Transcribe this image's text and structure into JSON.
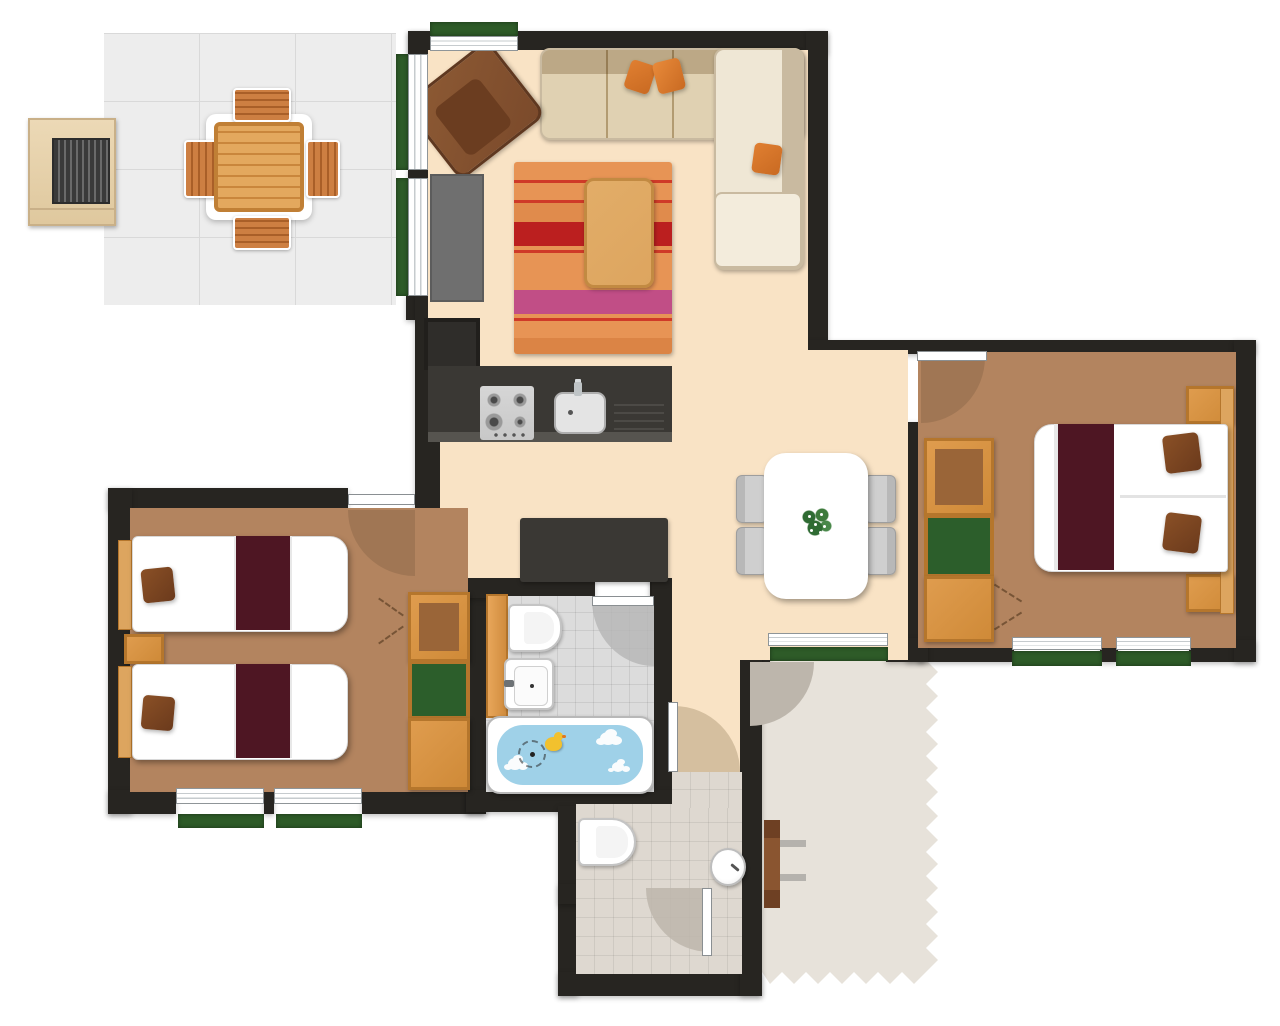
{
  "meta": {
    "kind": "floor-plan",
    "canvas_w": 1280,
    "canvas_h": 1026,
    "visible_text": "none"
  },
  "palette": {
    "wall": "#272521",
    "cream": "#f9e3c5",
    "wood_floor": "#b3845f",
    "bath_tile": "#dcdcdc",
    "wc_tile": "#ded8d0",
    "patio_tile": "#ededed",
    "path": "#e7e2da",
    "shutter_green": "#2e5b28",
    "orange_wood": "#df9c4e",
    "orange_wood_dark": "#b5762c",
    "shelf_green": "#2c5e2b",
    "shelf_brown": "#9a6538",
    "maroon": "#4e1623",
    "pillow_brown": "#7a4527",
    "sofa_cream": "#efe7d5",
    "sofa_border": "#c9baa0",
    "armchair_brown": "#7b4a2b",
    "cushion_orange": "#e07f31",
    "rug_base": "#e79455",
    "rug_red": "#cf3a28",
    "rug_dark_red": "#bb1f1f",
    "rug_magenta": "#c14e86",
    "table_wood": "#dda55f",
    "counter_dark": "#3a3834",
    "steel": "#d6d6d6",
    "chair_gray": "#cfcfcf",
    "water_blue": "#9fd1e8",
    "duck_yellow": "#f2c12e",
    "bench_wood": "#8a5530",
    "arc_wood": "#9c7352",
    "arc_gray": "#b5b5b5",
    "arc_tan": "#d5bf9f",
    "arc_path": "#bdb6ac",
    "tv_gray": "#6f6f6f",
    "dark_unit": "#2f2d2a"
  },
  "rooms": [
    {
      "id": "living-room",
      "floor": "cream",
      "furniture": [
        "corner-sofa",
        "sofa-cushions",
        "armchair",
        "striped-rug",
        "coffee-table",
        "media-unit"
      ]
    },
    {
      "id": "kitchen",
      "floor": "cream",
      "furniture": [
        "counter",
        "gas-hob",
        "sink",
        "drainer",
        "tall-appliance-unit"
      ]
    },
    {
      "id": "hall-dining",
      "floor": "cream",
      "furniture": [
        "dining-table",
        "dining-chairs-x4",
        "plant-centerpiece",
        "sideboard"
      ]
    },
    {
      "id": "master-bedroom",
      "floor": "wood",
      "furniture": [
        "double-bed",
        "maroon-runner",
        "pillows-x2",
        "headboard",
        "nightstand-x2",
        "wardrobe-with-shelves"
      ]
    },
    {
      "id": "twin-bedroom",
      "floor": "wood",
      "furniture": [
        "single-bed-x2",
        "maroon-runners",
        "pillows",
        "headboards",
        "nightstand",
        "wardrobe-with-shelves"
      ]
    },
    {
      "id": "bathroom",
      "floor": "bath-tile",
      "furniture": [
        "vanity-strip",
        "toilet",
        "washbasin",
        "bathtub",
        "bath-water",
        "foam-clouds-x3",
        "rubber-duck",
        "shower-head-dashed"
      ]
    },
    {
      "id": "wc",
      "floor": "wc-tile",
      "furniture": [
        "toilet",
        "round-washbasin",
        "inner-door"
      ]
    },
    {
      "id": "patio",
      "floor": "patio-tile",
      "furniture": [
        "bbq-grill",
        "garden-table",
        "garden-chairs-x4"
      ]
    },
    {
      "id": "entrance-path",
      "floor": "path",
      "furniture": [
        "bench",
        "entrance-door-arc"
      ]
    }
  ],
  "doors": [
    {
      "from": "hall-dining",
      "to": "master-bedroom"
    },
    {
      "from": "hall-dining",
      "to": "twin-bedroom"
    },
    {
      "from": "hall-dining",
      "to": "bathroom"
    },
    {
      "from": "corridor",
      "to": "wc"
    },
    {
      "from": "wc",
      "to": "inner-room"
    },
    {
      "from": "hall-dining",
      "to": "entrance-path"
    }
  ],
  "windows": [
    {
      "at": "living-room-top"
    },
    {
      "at": "living-room-left-glazing-x2"
    },
    {
      "at": "twin-bedroom-bottom-x2"
    },
    {
      "at": "master-bedroom-bottom-x2"
    },
    {
      "at": "hall-south-entrance"
    }
  ]
}
